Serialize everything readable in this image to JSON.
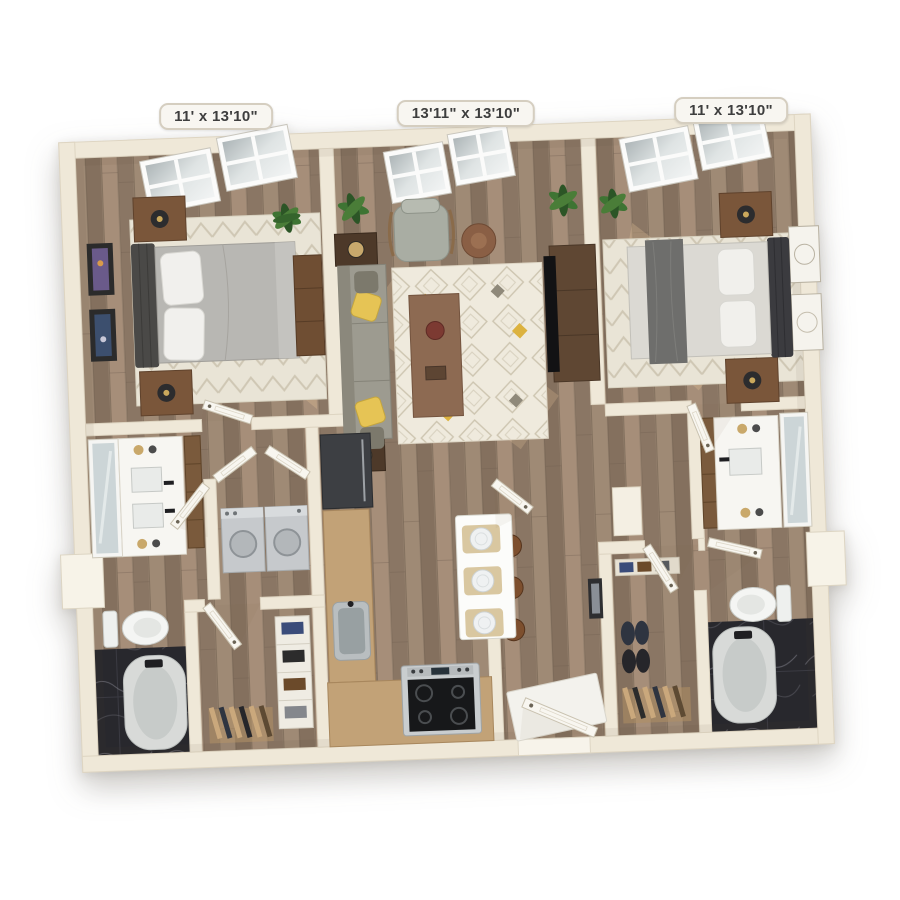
{
  "floorplan": {
    "labels": [
      {
        "room": "bedroom-left",
        "text": "11' x 13'10\""
      },
      {
        "room": "living-dining",
        "text": "13'11\" x 13'10\""
      },
      {
        "room": "bedroom-right",
        "text": "11' x 13'10\""
      }
    ],
    "rooms": [
      "bedroom-left",
      "living-dining-room",
      "bedroom-right",
      "bathroom-left",
      "bathroom-right",
      "closet-left",
      "closet-right",
      "laundry-closet",
      "kitchen",
      "entry-hall"
    ],
    "colors": {
      "background": "#ffffff",
      "wall": "#efe8d8",
      "wall_edge": "#ded5c2",
      "wood_floor": "#94806d",
      "marble_floor": "#28282d",
      "rug": "#e9e4d6",
      "sofa": "#9d9b90",
      "accent_pillow_yellow": "#e6c455",
      "bed_left": "#b8b7b3",
      "bed_right": "#dbd9d3",
      "headboard": "#4a4947",
      "nightstand": "#7a563a",
      "plant_green": "#3e7433",
      "island": "#fcfcfa",
      "stool": "#7d4f2e",
      "appliance_gray": "#c6c9cc",
      "range_black": "#17181a",
      "label_bg": "#f8f6f1",
      "label_border": "#d5cec0",
      "label_text": "#3e3e3e"
    }
  }
}
